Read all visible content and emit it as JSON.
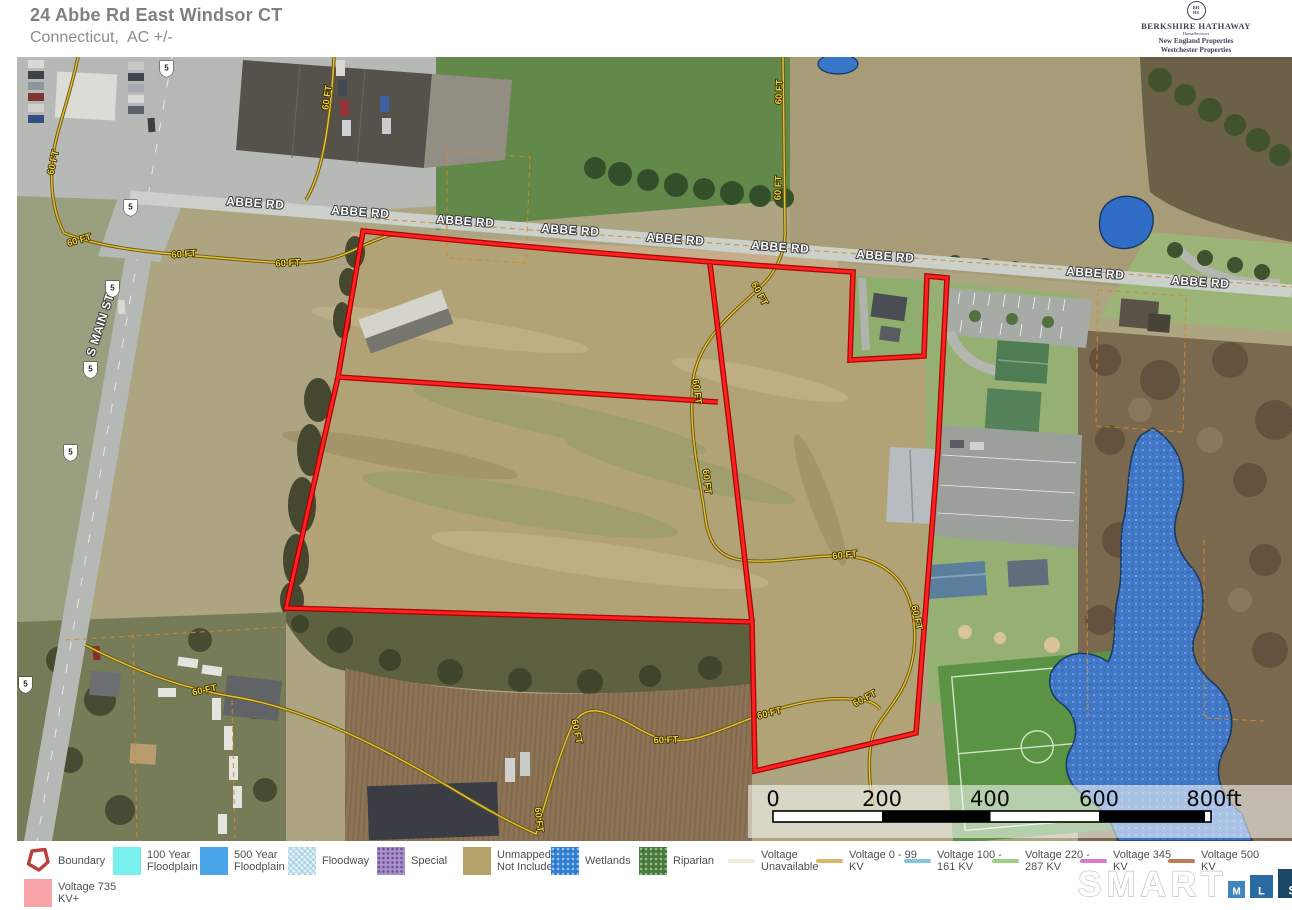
{
  "header": {
    "title": "24 Abbe Rd East Windsor CT",
    "subtitle": "Connecticut,  AC +/-"
  },
  "brand": {
    "monogram_top": "BH",
    "monogram_bottom": "HS",
    "name": "BERKSHIRE HATHAWAY",
    "homeservices": "HomeServices",
    "line1": "New England Properties",
    "line2": "Westchester Properties"
  },
  "map": {
    "road_label": "ABBE RD",
    "street_label": "S MAIN ST",
    "easement_label": "60 FT",
    "route_shield": "5",
    "boundary_color": "#ff2020",
    "easement_line_color": "#e3c23c",
    "wetland_color": "#4278c8"
  },
  "scale_bar": {
    "ticks": [
      "0",
      "200",
      "400",
      "600",
      "800ft"
    ]
  },
  "legend": {
    "items": [
      {
        "label": "Boundary",
        "color": "#b9413d",
        "type": "boundary-outline"
      },
      {
        "label": "100 Year\nFloodplain",
        "color": "#78f1ee",
        "type": "solid"
      },
      {
        "label": "500 Year\nFloodplain",
        "color": "#4ba6e9",
        "type": "solid"
      },
      {
        "label": "Floodway",
        "color": "#dceff5",
        "type": "crosshatch"
      },
      {
        "label": "Special",
        "color": "#a992cb",
        "type": "dots"
      },
      {
        "label": "Unmapped/\nNot Included",
        "color": "#b5a269",
        "type": "solid"
      },
      {
        "label": "Wetlands",
        "color": "#2e7ed4",
        "type": "dots"
      },
      {
        "label": "Riparian",
        "color": "#45793a",
        "type": "dots"
      },
      {
        "label": "Voltage\nUnavailable",
        "color": "#f0ecd8",
        "type": "line"
      },
      {
        "label": "Voltage 0 - 99\nKV",
        "color": "#dcb76a",
        "type": "line"
      },
      {
        "label": "Voltage 100 -\n161 KV",
        "color": "#86c5dc",
        "type": "line"
      },
      {
        "label": "Voltage 220 -\n287 KV",
        "color": "#9cd285",
        "type": "line"
      },
      {
        "label": "Voltage 345\nKV",
        "color": "#d878ce",
        "type": "line"
      },
      {
        "label": "Voltage 500\nKV",
        "color": "#bf7a58",
        "type": "line"
      },
      {
        "label": "Voltage  735\nKV+",
        "color": "#f8a3a8",
        "type": "solid"
      }
    ]
  },
  "footer_logo": {
    "word": "SMART",
    "squares": [
      "M",
      "L",
      "S"
    ]
  }
}
